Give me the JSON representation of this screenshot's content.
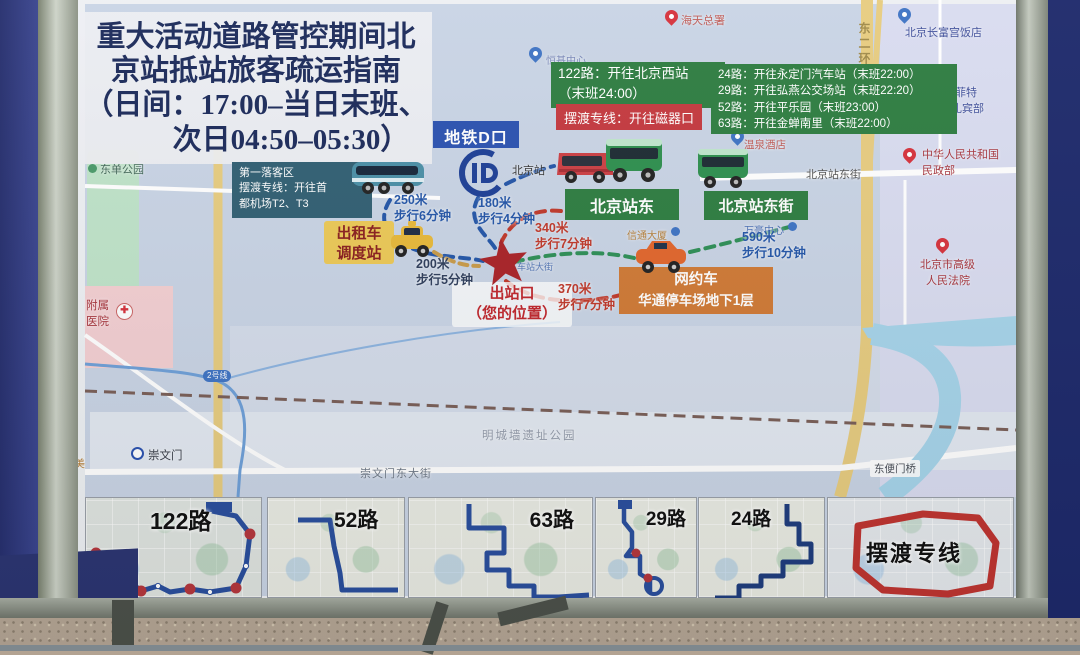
{
  "title": {
    "line1": "重大活动道路管控期间北",
    "line2": "京站抵站旅客疏运指南",
    "line3": "（日间：17:00–当日末班、",
    "line4": "次日04:50–05:30）"
  },
  "colors": {
    "bus_green": "#2e7d41",
    "ferry_red": "#c4393f",
    "metro_blue": "#2b52b0",
    "ridehail_orange": "#d07a36",
    "taxi_yellow": "#ecc957",
    "title_navy": "#1b2a5a",
    "dropoff_teal": "#315f73"
  },
  "info_boxes": {
    "bus122_line1": "122路：开往北京西站",
    "bus122_line2": "（末班24:00）",
    "ferry_line": "摆渡专线：开往磁器口",
    "bus_list": {
      "l1": "24路：开往永定门汽车站（末班22:00）",
      "l2": "29路：开往弘燕公交场站（末班22:20）",
      "l3": "52路：开往平乐园（末班23:00）",
      "l4": "63路：开往金蝉南里（末班22:00）"
    },
    "metro_entrance": "地铁D口",
    "dropoff": {
      "l1": "第一落客区",
      "l2": "摆渡专线：开往首",
      "l3": "都机场T2、T3"
    },
    "taxi_stand": {
      "l1": "出租车",
      "l2": "调度站"
    },
    "station_east": "北京站东",
    "station_east_street": "北京站东街",
    "ride_hail": {
      "l1": "网约车",
      "l2": "华通停车场地下1层"
    },
    "exit": {
      "l1": "出站口",
      "l2": "（您的位置）"
    }
  },
  "distances": {
    "d250": {
      "m": "250米",
      "t": "步行6分钟"
    },
    "d180": {
      "m": "180米",
      "t": "步行4分钟"
    },
    "d340": {
      "m": "340米",
      "t": "步行7分钟"
    },
    "d200": {
      "m": "200米",
      "t": "步行5分钟"
    },
    "d370": {
      "m": "370米",
      "t": "步行7分钟"
    },
    "d590": {
      "m": "590米",
      "t": "步行10分钟"
    }
  },
  "map_labels": {
    "beijing_station": "北京站",
    "hengji_center": "恒基中心",
    "dongdan_park": "东单公园",
    "fushu_line1": "附属",
    "fushu_line2": "医院",
    "chongwenmen": "崇文门",
    "duomei": "多美",
    "line2_badge": "2号线",
    "chongwenmen_east_street": "崇文门东大街",
    "ming_wall_park": "明城墙遗址公园",
    "dongbianmen_bridge": "东便门桥",
    "station_street": "车站大街",
    "xintong_tower": "信通大厦",
    "wanhao_center": "万豪中心",
    "wenquan_hotel": "温泉酒店",
    "station_east_street_road": "北京站东街",
    "haitian": "海天总署",
    "dongerhuan": "东二环",
    "changfugong_hotel": "北京长富宫饭店",
    "sofitel_line1": "索菲特",
    "sofitel_line2": "店礼宾部",
    "minzheng_line1": "中华人民共和国",
    "minzheng_line2": "民政部",
    "court_line1": "北京市高级",
    "court_line2": "人民法院"
  },
  "thumbnails": [
    {
      "label": "122路"
    },
    {
      "label": "52路"
    },
    {
      "label": "63路"
    },
    {
      "label": "29路"
    },
    {
      "label": "24路"
    },
    {
      "label": "摆渡专线"
    }
  ]
}
